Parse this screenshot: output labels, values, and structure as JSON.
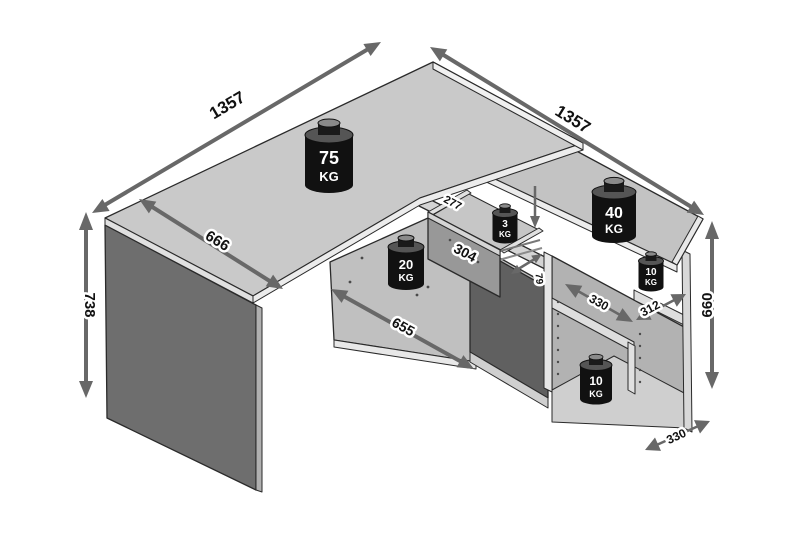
{
  "diagram": {
    "title": "corner-desk-dimension-diagram",
    "dims": {
      "desk_length_left": "1357",
      "desk_length_right": "1357",
      "desk_depth": "666",
      "desk_height": "738",
      "low_shelf_length": "655",
      "shelf_unit_height": "660",
      "shelf_left_width": "330",
      "shelf_right_width": "312",
      "unit_depth": "330",
      "rear_rail_depth": "277",
      "drawer_front_width": "304",
      "drawer_inner_height": "79"
    },
    "weights": {
      "desktop": {
        "value": "75",
        "unit": "KG"
      },
      "return_top": {
        "value": "40",
        "unit": "KG"
      },
      "low_shelf": {
        "value": "20",
        "unit": "KG"
      },
      "drawer": {
        "value": "3",
        "unit": "KG"
      },
      "upper_shelf": {
        "value": "10",
        "unit": "KG"
      },
      "bottom_shelf": {
        "value": "10",
        "unit": "KG"
      }
    },
    "colors": {
      "background": "#ffffff",
      "desk_surface": "#c9c9c9",
      "return_surface": "#c3c3c3",
      "panel_dark": "#6e6e6e",
      "interior": "#b2b2b2",
      "arrow": "#686868",
      "weight_body": "#111111",
      "outline": "#2a2a2a"
    }
  }
}
